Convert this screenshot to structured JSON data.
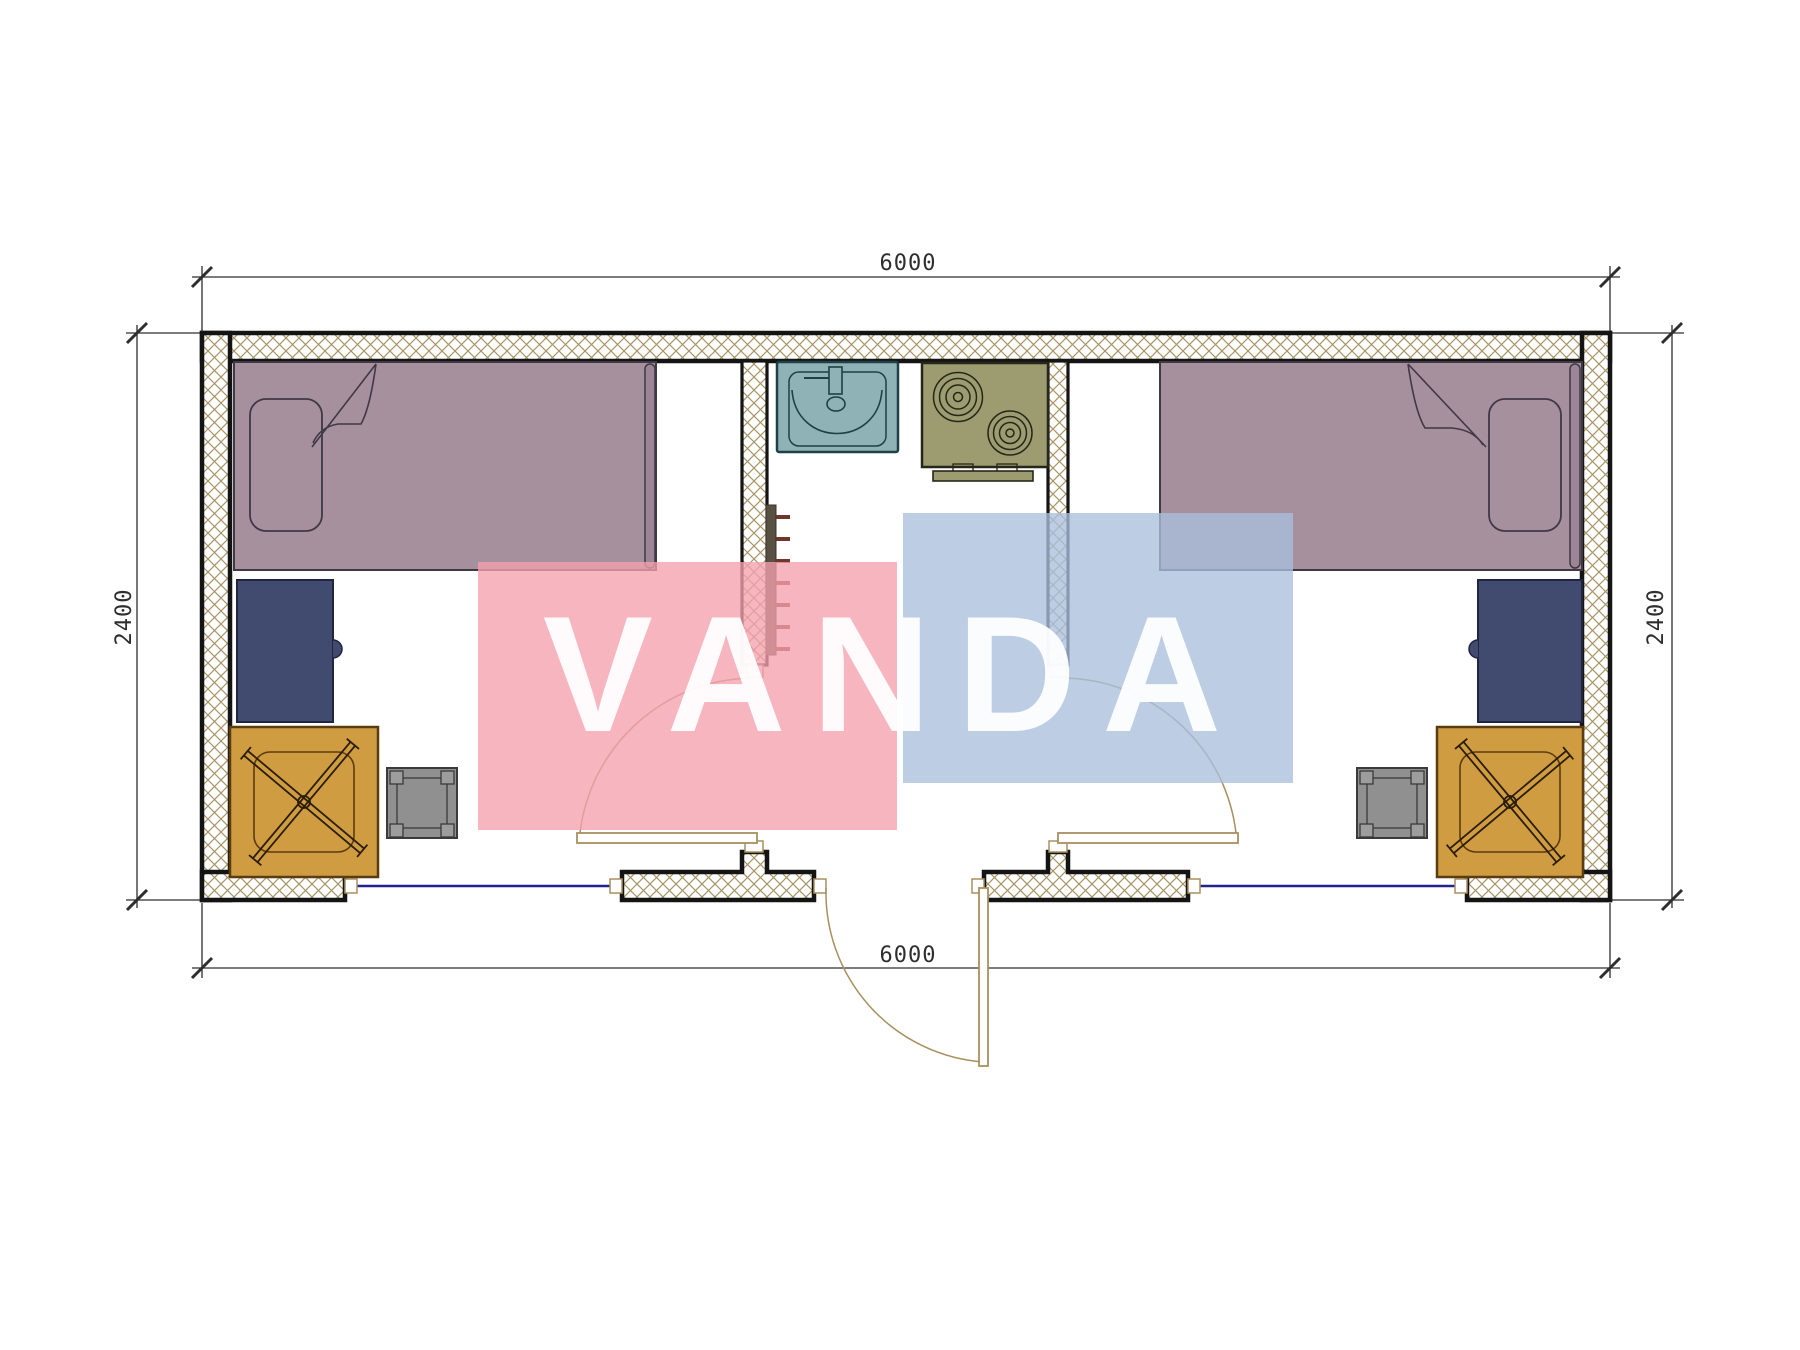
{
  "watermark": {
    "text": "VANDA"
  },
  "dimensions": {
    "top": "6000",
    "bottom": "6000",
    "left": "2400",
    "right": "2400"
  },
  "colors": {
    "wallline": "#141414",
    "hatch": "#a89567",
    "window": "#22228a",
    "door": "#a8905e",
    "dim": "#2e2e2e",
    "bed": "#a7909e",
    "bedborder": "#3f3845",
    "bedstrip": "#9c8595",
    "desk": "#414b70",
    "deskborder": "#20263f",
    "chair": "#d09c42",
    "chairborder": "#5b3c10",
    "chairline": "#2a1d06",
    "stool": "#909090",
    "stoolcorner": "#9d9d9d",
    "stoolborder": "#3a3a3a",
    "sink": "#8fb2b6",
    "sinkline": "#1f4045",
    "stove": "#9c9c70",
    "stoveline": "#26261a",
    "radiator": "#575043",
    "radtick": "#6f372b",
    "wmred": "rgba(243,160,173,0.78)",
    "wmblue": "rgba(169,191,220,0.78)",
    "wmtext": "rgba(255,255,255,0.93)"
  }
}
